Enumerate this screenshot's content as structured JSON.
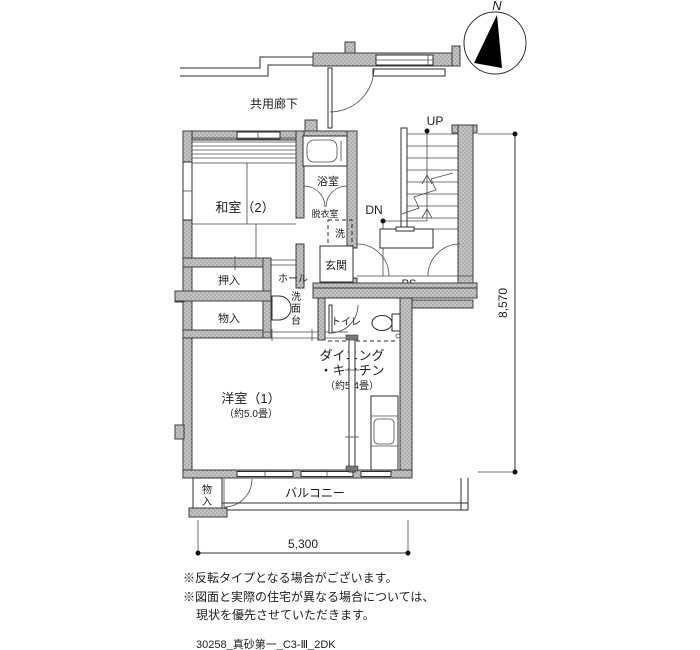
{
  "compass": {
    "north": "N"
  },
  "labels": {
    "corridor": "共用廊下",
    "up": "UP",
    "dn": "DN",
    "ps": "PS",
    "bath": "浴室",
    "dressing": "脱衣室",
    "washer": "洗",
    "entrance": "玄関",
    "japanese_room2": "和室（2）",
    "oshiire": "押入",
    "storage_hall": "物入",
    "hall": "ホール",
    "washstand": "洗面台",
    "toilet": "トイレ",
    "dk_line1": "ダイニング",
    "dk_line2": "・キッチン",
    "dk_size": "（約5.4畳）",
    "western_room1": "洋室（1）",
    "western_room1_size": "（約5.0畳）",
    "balcony": "バルコニー",
    "storage_balcony": "物入"
  },
  "dimensions": {
    "width_mm": "5,300",
    "height_mm": "8,570"
  },
  "notes": [
    "※反転タイプとなる場合がございます。",
    "※図面と実際の住宅が異なる場合については、",
    "現状を優先させていただきます。"
  ],
  "plan_id": "30258_真砂第一_C3-Ⅲ_2DK",
  "colors": {
    "wall": "#bdbdbd",
    "wall_dot": "#8f8f8f",
    "line": "#2e2e2e",
    "text": "#1d1d1d",
    "bg": "#ffffff"
  }
}
